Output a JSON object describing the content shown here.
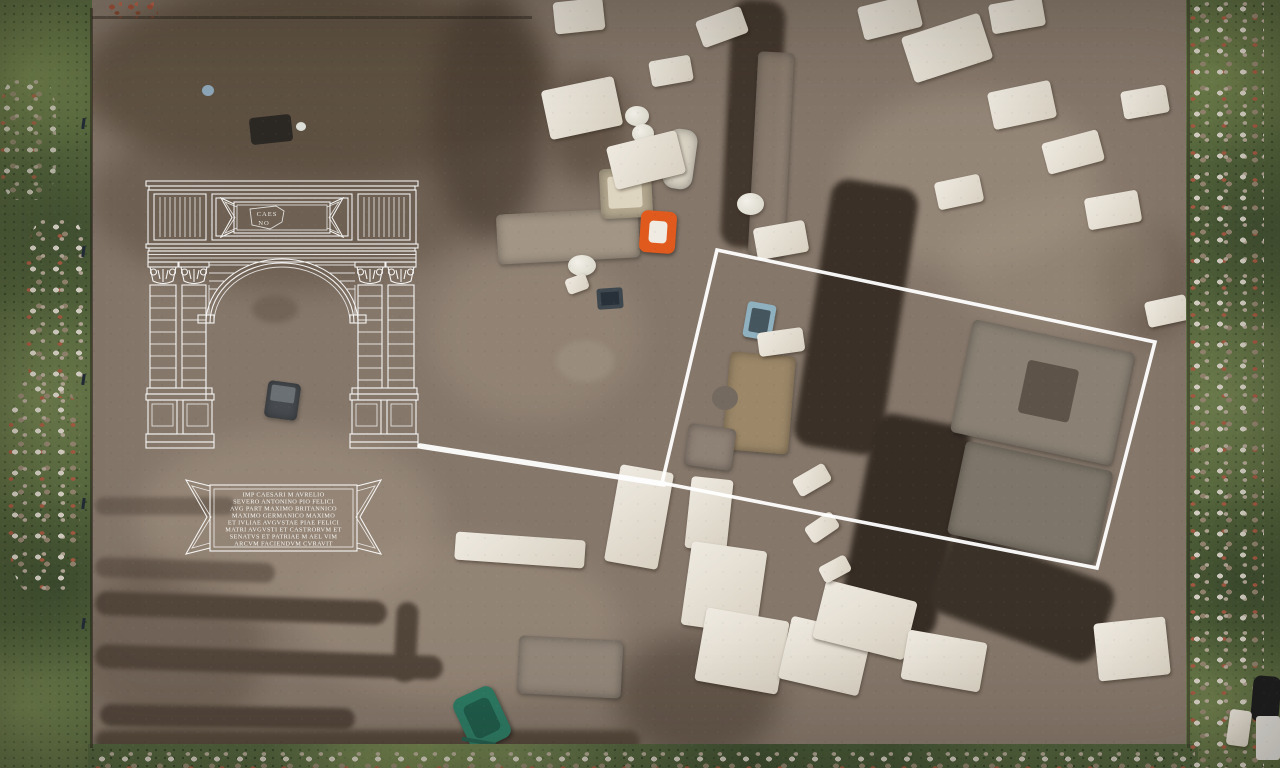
{
  "overlay": {
    "arch_fragment_label": {
      "line1": "CAES",
      "line2": "NO"
    },
    "inscription": {
      "lines": [
        "IMP CAESARI M AVRELIO",
        "SEVERO ANTONINO PIO FELICI",
        "AVG PART MAXIMO BRITANNICO",
        "MAXIMO GERMANICO MAXIMO",
        "ET IVLIAE AVGVSTAE PIAE FELICI",
        "MATRI AVGVSTI ET CASTRORVM ET",
        "SENATVS ET PATRIAE M AEL VIM",
        "ARCVM FACIENDVM CVRAVIT"
      ]
    }
  },
  "colors": {
    "annotation_white": "#ffffff",
    "grass_green": "#57683e",
    "soil_brown": "#85776a",
    "trench_dark": "#3a3027",
    "stone_white": "#e6e1d8",
    "wheelbarrow_orange": "#e05a1e",
    "wheelbarrow_green": "#2c7a63"
  }
}
